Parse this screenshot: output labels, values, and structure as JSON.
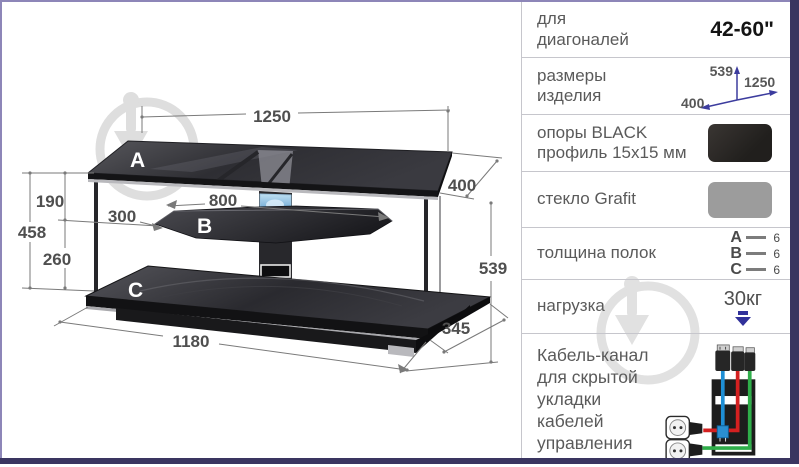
{
  "colors": {
    "border_accent": "#8d86b8",
    "border_dark": "#3a3560",
    "divider_gray": "#c6c6cc",
    "text_gray": "#5a5a5a",
    "dim_text_gray": "#4f4f4f",
    "value_black": "#141414",
    "arrow_blue": "#3c3c9e",
    "swatch_black": "#2b2826",
    "swatch_gray": "#9c9c9c",
    "cable_red": "#d42020",
    "cable_blue": "#1e8fd5",
    "cable_green": "#2fae4a",
    "watermark_gray": "#d9d9d9"
  },
  "diagram": {
    "shelf_labels": {
      "a": "A",
      "b": "B",
      "c": "C"
    },
    "dims": {
      "top_width": "1250",
      "top_depth": "400",
      "shelf_gap_top": "190",
      "side_height": "458",
      "shelf_gap_bottom": "260",
      "middle_shelf_width": "800",
      "middle_shelf_inset": "300",
      "total_height": "539",
      "base_width": "1180",
      "base_depth": "345"
    }
  },
  "panel": {
    "diagonal": {
      "label": "для диагоналей",
      "value": "42-60\""
    },
    "size": {
      "label": "размеры изделия",
      "height": "539",
      "width": "1250",
      "depth": "400"
    },
    "supports": {
      "label": "опоры BLACK профиль 15x15 мм"
    },
    "glass": {
      "label": "стекло Grafit"
    },
    "thickness": {
      "label": "толщина полок",
      "items": [
        {
          "k": "A",
          "v": "6"
        },
        {
          "k": "B",
          "v": "6"
        },
        {
          "k": "C",
          "v": "6"
        }
      ]
    },
    "load": {
      "label": "нагрузка",
      "value": "30кг"
    },
    "cable": {
      "label": "Кабель-канал для скрытой укладки кабелей управления"
    }
  }
}
